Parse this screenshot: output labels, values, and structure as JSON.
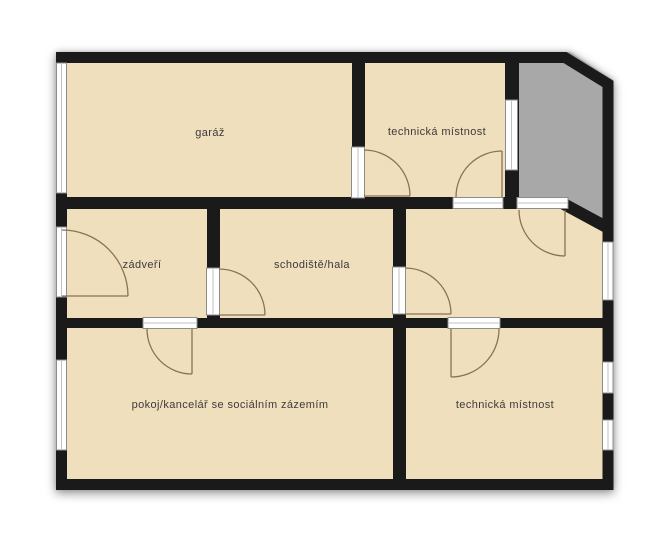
{
  "plan": {
    "title": "floor-plan",
    "rooms": [
      {
        "id": "garaz",
        "label": "garáž"
      },
      {
        "id": "technicka-mistnost-top",
        "label": "technická místnost"
      },
      {
        "id": "zadveri",
        "label": "zádveří"
      },
      {
        "id": "schodiste-hala",
        "label": "schodiště/hala"
      },
      {
        "id": "pokoj-kancelar",
        "label": "pokoj/kancelář se sociálním zázemím"
      },
      {
        "id": "technicka-mistnost-bottom",
        "label": "technická místnost"
      }
    ],
    "colors": {
      "background": "#ffffff",
      "room_fill": "#f0dfbc",
      "terrace_fill": "#a8a8a8",
      "wall": "#1a1a1a",
      "door_arc": "#8a7254",
      "frame_fill": "#ffffff",
      "frame_border": "#8c8c8c",
      "frame_line": "#c0c0c0",
      "label_text": "#3b3b3b"
    }
  }
}
